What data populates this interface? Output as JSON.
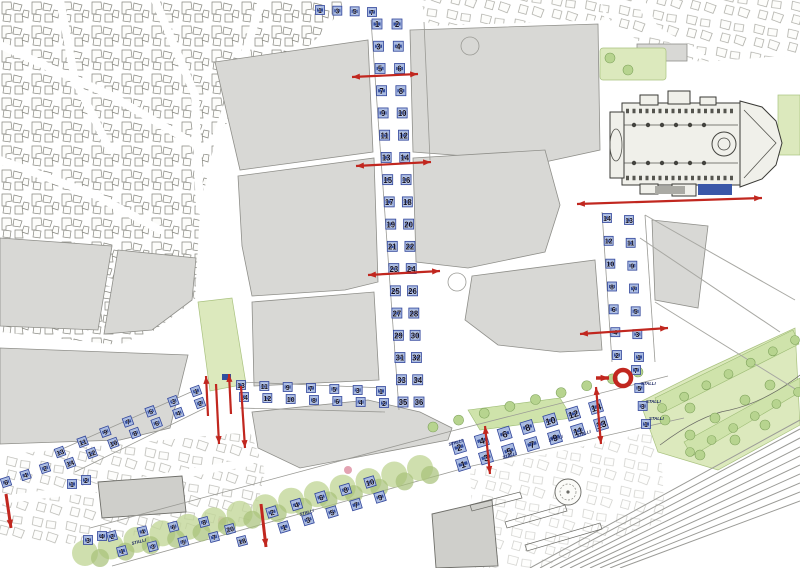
{
  "map": {
    "description": "urban parking plan with numbered stalls",
    "colors": {
      "background": "#ffffff",
      "block_fill": "#d8d8d5",
      "stall_fill": "#a9bbe2",
      "stall_mark": "#1f3a8f",
      "stall_stroke": "#32469b",
      "stall_number": "#0c0c20",
      "arrow_red": "#c1271f",
      "green_light": "#dce9bd",
      "green_tree": "#b7d48f",
      "green_tree_dark": "#7fa35c",
      "rail": "#9b9b97"
    },
    "labels": {
      "stalli": "STALLI"
    },
    "stall_groups": [
      {
        "id": "top-row",
        "x1": 320,
        "y1": 10,
        "x2": 372,
        "y2": 12,
        "size": 9,
        "rot": 0,
        "numbers": [
          1,
          3,
          5,
          7
        ]
      },
      {
        "id": "main-street-west",
        "x1": 377,
        "y1": 24,
        "x2": 403,
        "y2": 402,
        "size": 10,
        "rot": 0,
        "numbers": [
          1,
          3,
          5,
          7,
          9,
          11,
          13,
          15,
          17,
          19,
          21,
          23,
          25,
          27,
          29,
          31,
          33,
          35
        ]
      },
      {
        "id": "main-street-east",
        "x1": 397,
        "y1": 24,
        "x2": 419,
        "y2": 402,
        "size": 10,
        "rot": 0,
        "numbers": [
          2,
          4,
          6,
          8,
          10,
          12,
          14,
          16,
          18,
          20,
          22,
          24,
          26,
          28,
          30,
          32,
          34,
          36
        ]
      },
      {
        "id": "right-street-west",
        "x1": 607,
        "y1": 218,
        "x2": 617,
        "y2": 355,
        "size": 9,
        "rot": 0,
        "numbers": [
          14,
          12,
          10,
          8,
          6,
          4,
          2
        ]
      },
      {
        "id": "right-street-east",
        "x1": 629,
        "y1": 220,
        "x2": 639,
        "y2": 357,
        "size": 9,
        "rot": 0,
        "numbers": [
          13,
          11,
          9,
          7,
          5,
          3,
          1
        ]
      },
      {
        "id": "right-street-lower",
        "x1": 636,
        "y1": 370,
        "x2": 646,
        "y2": 424,
        "size": 9,
        "rot": 0,
        "numbers": [
          7,
          5,
          3,
          1
        ]
      },
      {
        "id": "cross-street-east-odd",
        "x1": 381,
        "y1": 391,
        "x2": 241,
        "y2": 385,
        "size": 9,
        "rot": 0,
        "numbers": [
          1,
          3,
          5,
          7,
          9,
          11,
          13
        ]
      },
      {
        "id": "cross-street-east-even",
        "x1": 384,
        "y1": 403,
        "x2": 244,
        "y2": 397,
        "size": 9,
        "rot": 0,
        "numbers": [
          2,
          4,
          6,
          8,
          10,
          12,
          14
        ]
      },
      {
        "id": "cross-street-west-odd",
        "x1": 196,
        "y1": 391,
        "x2": 60,
        "y2": 452,
        "size": 9,
        "rot": -20,
        "numbers": [
          1,
          3,
          5,
          7,
          9,
          11,
          13
        ]
      },
      {
        "id": "cross-street-west-even",
        "x1": 200,
        "y1": 403,
        "x2": 70,
        "y2": 463,
        "size": 9,
        "rot": -20,
        "numbers": [
          2,
          4,
          6,
          8,
          10,
          12,
          14
        ]
      },
      {
        "id": "left-edge-row",
        "x1": 45,
        "y1": 468,
        "x2": 6,
        "y2": 482,
        "size": 9,
        "rot": -18,
        "numbers": [
          2,
          4,
          6
        ]
      },
      {
        "id": "mini-street-w",
        "x1": 72,
        "y1": 484,
        "x2": 88,
        "y2": 540,
        "size": 9,
        "rot": 0,
        "numbers": [
          1,
          3
        ]
      },
      {
        "id": "mini-street-e",
        "x1": 86,
        "y1": 480,
        "x2": 102,
        "y2": 536,
        "size": 9,
        "rot": 0,
        "numbers": [
          2,
          4
        ]
      },
      {
        "id": "boulevard-sw-even",
        "x1": 112,
        "y1": 536,
        "x2": 204,
        "y2": 522,
        "size": 9,
        "rot": -15,
        "numbers": [
          2,
          4,
          6,
          8
        ]
      },
      {
        "id": "boulevard-sw-odd",
        "x1": 122,
        "y1": 551,
        "x2": 214,
        "y2": 537,
        "size": 9,
        "rot": -15,
        "numbers": [
          1,
          3,
          5,
          7
        ]
      },
      {
        "id": "boulevard-sw-upper",
        "x1": 230,
        "y1": 529,
        "x2": 242,
        "y2": 541,
        "size": 9,
        "rot": -15,
        "numbers": [
          20,
          18
        ]
      },
      {
        "id": "boulevard-mid-even",
        "x1": 272,
        "y1": 512,
        "x2": 370,
        "y2": 482,
        "size": 10,
        "rot": -17,
        "numbers": [
          2,
          4,
          6,
          8,
          10
        ]
      },
      {
        "id": "boulevard-mid-odd",
        "x1": 284,
        "y1": 527,
        "x2": 380,
        "y2": 497,
        "size": 10,
        "rot": -17,
        "numbers": [
          1,
          3,
          5,
          7,
          9
        ]
      },
      {
        "id": "avenue-even",
        "x1": 459,
        "y1": 447,
        "x2": 596,
        "y2": 407,
        "size": 12,
        "rot": -17,
        "numbers": [
          2,
          4,
          6,
          8,
          10,
          12,
          14
        ]
      },
      {
        "id": "avenue-odd",
        "x1": 463,
        "y1": 464,
        "x2": 601,
        "y2": 424,
        "size": 12,
        "rot": -17,
        "numbers": [
          1,
          3,
          5,
          7,
          9,
          11,
          13
        ]
      }
    ],
    "stalli_labels": [
      {
        "x": 449,
        "y": 446,
        "rot": -17
      },
      {
        "x": 503,
        "y": 459,
        "rot": -17
      },
      {
        "x": 549,
        "y": 442,
        "rot": -17
      },
      {
        "x": 577,
        "y": 437,
        "rot": -17
      },
      {
        "x": 641,
        "y": 385,
        "rot": 0
      },
      {
        "x": 646,
        "y": 403,
        "rot": 0
      },
      {
        "x": 649,
        "y": 420,
        "rot": 0
      },
      {
        "x": 132,
        "y": 545,
        "rot": -15
      },
      {
        "x": 300,
        "y": 516,
        "rot": -17
      }
    ],
    "arrows": [
      {
        "x1": 352,
        "y1": 77,
        "x2": 418,
        "y2": 74,
        "heads": 2
      },
      {
        "x1": 356,
        "y1": 166,
        "x2": 431,
        "y2": 162,
        "heads": 2
      },
      {
        "x1": 368,
        "y1": 275,
        "x2": 440,
        "y2": 271,
        "heads": 2
      },
      {
        "x1": 577,
        "y1": 204,
        "x2": 762,
        "y2": 198,
        "heads": 2
      },
      {
        "x1": 580,
        "y1": 334,
        "x2": 668,
        "y2": 328,
        "heads": 2
      },
      {
        "x1": 208,
        "y1": 416,
        "x2": 206,
        "y2": 376,
        "heads": 1
      },
      {
        "x1": 231,
        "y1": 414,
        "x2": 229,
        "y2": 374,
        "heads": 1
      },
      {
        "x1": 216,
        "y1": 384,
        "x2": 219,
        "y2": 444,
        "heads": 1
      },
      {
        "x1": 241,
        "y1": 386,
        "x2": 245,
        "y2": 448,
        "heads": 1
      },
      {
        "x1": 490,
        "y1": 474,
        "x2": 485,
        "y2": 426,
        "heads": 2
      },
      {
        "x1": 601,
        "y1": 444,
        "x2": 596,
        "y2": 387,
        "heads": 2
      },
      {
        "x1": 261,
        "y1": 504,
        "x2": 266,
        "y2": 547,
        "heads": 1,
        "w": 3
      },
      {
        "x1": 6,
        "y1": 494,
        "x2": 11,
        "y2": 528,
        "heads": 1,
        "w": 3
      },
      {
        "x1": 596,
        "y1": 378,
        "x2": 609,
        "y2": 378,
        "heads": 1,
        "w": 3.5
      }
    ],
    "no_entry_sign": {
      "cx": 623,
      "cy": 378,
      "r": 8
    }
  }
}
